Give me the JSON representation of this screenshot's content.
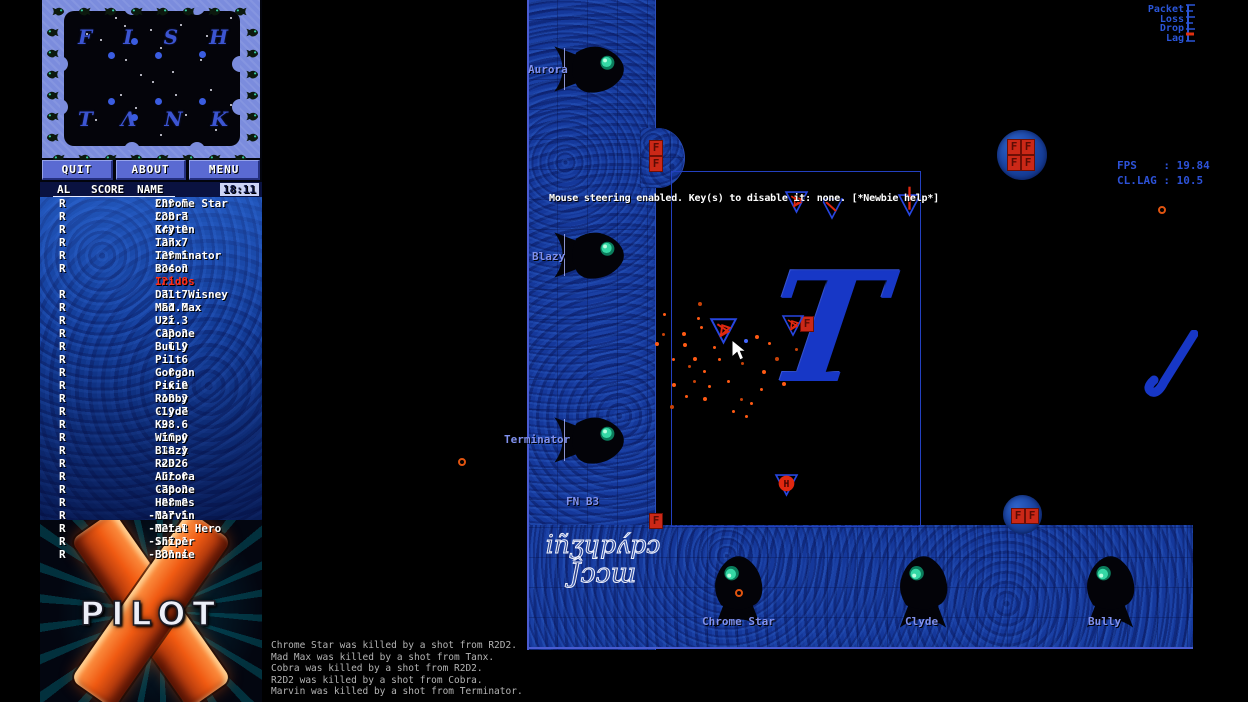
{
  "window": {
    "width": 1248,
    "height": 702,
    "app": "XPilot"
  },
  "colors": {
    "hud_blue": "#2d52d8",
    "label_blue": "#8091ee",
    "wall_blue": "#15389a",
    "self_red": "#ff2e18",
    "fuel_red": "#cb2817",
    "orange_debris": "#ff5a14",
    "ship_blue": "#2746e0",
    "frame_periwinkle": "#7b8cdd"
  },
  "radar": {
    "map_title_top": [
      "F",
      "I",
      "S",
      "H"
    ],
    "map_title_bottom": [
      "T",
      "Λ",
      "N",
      "K"
    ],
    "stars": [
      [
        51,
        6
      ],
      [
        86,
        18
      ],
      [
        116,
        13
      ],
      [
        166,
        6
      ],
      [
        36,
        28
      ],
      [
        61,
        48
      ],
      [
        96,
        36
      ],
      [
        136,
        48
      ],
      [
        76,
        63
      ],
      [
        88,
        70
      ],
      [
        56,
        83
      ],
      [
        111,
        83
      ],
      [
        146,
        78
      ],
      [
        166,
        93
      ],
      [
        31,
        108
      ],
      [
        71,
        96
      ],
      [
        121,
        103
      ],
      [
        151,
        118
      ],
      [
        96,
        123
      ],
      [
        174,
        46
      ],
      [
        22,
        22
      ],
      [
        142,
        24
      ],
      [
        60,
        14
      ],
      [
        108,
        60
      ]
    ],
    "planets": [
      [
        47,
        44
      ],
      [
        94,
        44
      ],
      [
        138,
        43
      ],
      [
        47,
        90
      ],
      [
        94,
        90
      ],
      [
        138,
        90
      ],
      [
        70,
        30
      ],
      [
        70,
        106
      ]
    ]
  },
  "menu_buttons": [
    {
      "label": "QUIT"
    },
    {
      "label": "ABOUT"
    },
    {
      "label": "MENU"
    }
  ],
  "score_table": {
    "col_al": "AL",
    "col_score": "SCORE",
    "col_name": "NAME",
    "clock": "18:11",
    "rows": [
      {
        "flag": "R",
        "score": "229.5",
        "name": "Chrome Star",
        "self": false
      },
      {
        "flag": "R",
        "score": "223.7",
        "name": "Cobra",
        "self": false
      },
      {
        "flag": "R",
        "score": "143.9",
        "name": "Kryten",
        "self": false
      },
      {
        "flag": "R",
        "score": "137.7",
        "name": "Tanx",
        "self": false
      },
      {
        "flag": "R",
        "score": "129.5",
        "name": "Terminator",
        "self": false
      },
      {
        "flag": "R",
        "score": "124.3",
        "name": "Boson",
        "self": false
      },
      {
        "flag": "",
        "score": "121.8",
        "name": "Iridos",
        "self": true
      },
      {
        "flag": "R",
        "score": "71.7",
        "name": "Dalt Wisney",
        "self": false
      },
      {
        "flag": "R",
        "score": "51.9",
        "name": "Mad Max",
        "self": false
      },
      {
        "flag": "R",
        "score": "32.3",
        "name": "Uzi",
        "self": false
      },
      {
        "flag": "R",
        "score": "32.2",
        "name": "Capone",
        "self": false
      },
      {
        "flag": "R",
        "score": "6.9",
        "name": "Bully",
        "self": false
      },
      {
        "flag": "R",
        "score": "1.6",
        "name": "Pilt",
        "self": false
      },
      {
        "flag": "R",
        "score": "0.3",
        "name": "Gorgon",
        "self": false
      },
      {
        "flag": "R",
        "score": "-6.9",
        "name": "Pixie",
        "self": false
      },
      {
        "flag": "R",
        "score": "-18.3",
        "name": "Robby",
        "self": false
      },
      {
        "flag": "R",
        "score": "-19.7",
        "name": "Clyde",
        "self": false
      },
      {
        "flag": "R",
        "score": "-28.6",
        "name": "K9",
        "self": false
      },
      {
        "flag": "R",
        "score": "-36.0",
        "name": "Wimpy",
        "self": false
      },
      {
        "flag": "R",
        "score": "-38.1",
        "name": "Blazy",
        "self": false
      },
      {
        "flag": "R",
        "score": "-45.6",
        "name": "R2D2",
        "self": false
      },
      {
        "flag": "R",
        "score": "-51.0",
        "name": "Aurora",
        "self": false
      },
      {
        "flag": "R",
        "score": "-78.2",
        "name": "Capone",
        "self": false
      },
      {
        "flag": "R",
        "score": "-88.8",
        "name": "Hermes",
        "self": false
      },
      {
        "flag": "R",
        "score": "-117.5",
        "name": "Marvin",
        "self": false
      },
      {
        "flag": "R",
        "score": "-121.8",
        "name": "Metal Hero",
        "self": false
      },
      {
        "flag": "R",
        "score": "-157.1",
        "name": "Sniper",
        "self": false
      },
      {
        "flag": "R",
        "score": "-231.4",
        "name": "Bonnie",
        "self": false
      }
    ]
  },
  "logo": {
    "text": "PILOT"
  },
  "kill_feed": [
    "Chrome Star was killed by a shot from R2D2.",
    "Mad Max was killed by a shot from Tanx.",
    "Cobra was killed by a shot from R2D2.",
    "R2D2 was killed by a shot from Cobra.",
    "Marvin was killed by a shot from Terminator."
  ],
  "hud": {
    "message": "Mouse steering enabled. Key(s) to disable it: none. [*Newbie help*]",
    "fps": "FPS    : 19.84",
    "cl_lag": "CL.LAG : 10.5",
    "net_meter_labels": [
      "Packet",
      "Loss",
      "Drop",
      "Lag"
    ]
  },
  "game": {
    "player_labels": [
      {
        "text": "Aurora",
        "x": 528,
        "y": 63
      },
      {
        "text": "Blazy",
        "x": 532,
        "y": 250
      },
      {
        "text": "Terminator",
        "x": 504,
        "y": 433
      },
      {
        "text": "Chrome Star",
        "x": 702,
        "y": 615
      },
      {
        "text": "Clyde",
        "x": 905,
        "y": 615
      },
      {
        "text": "Bully",
        "x": 1088,
        "y": 615
      }
    ],
    "base_label": {
      "text": "FN B3",
      "x": 566,
      "y": 495
    },
    "decoration_letters": {
      "big_t": "T",
      "script_line1": "iñʒɥpʌ́pɔ",
      "script_line2": "Ĵɔɔɯ"
    },
    "wall_fish": [
      {
        "x": 552,
        "y": 42,
        "w": 78,
        "h": 54,
        "dir": "right"
      },
      {
        "x": 552,
        "y": 228,
        "w": 78,
        "h": 54,
        "dir": "right"
      },
      {
        "x": 552,
        "y": 413,
        "w": 78,
        "h": 54,
        "dir": "right"
      },
      {
        "x": 710,
        "y": 550,
        "w": 56,
        "h": 80,
        "dir": "up"
      },
      {
        "x": 895,
        "y": 550,
        "w": 56,
        "h": 80,
        "dir": "up"
      },
      {
        "x": 1082,
        "y": 550,
        "w": 56,
        "h": 80,
        "dir": "up"
      }
    ],
    "fuel": {
      "letter": "F",
      "cells": [
        [
          649,
          140
        ],
        [
          649,
          156
        ],
        [
          1007,
          139
        ],
        [
          1021,
          139
        ],
        [
          1007,
          155
        ],
        [
          1021,
          155
        ],
        [
          649,
          513
        ],
        [
          1011,
          508
        ],
        [
          1025,
          508
        ],
        [
          800,
          316
        ]
      ]
    },
    "islands": [
      {
        "x": 997,
        "y": 130,
        "d": 50
      },
      {
        "x": 1003,
        "y": 495,
        "d": 39
      }
    ],
    "ships": [
      {
        "x": 710,
        "y": 316,
        "size": 27,
        "variant": "debris"
      },
      {
        "x": 782,
        "y": 313,
        "size": 22,
        "variant": "debris"
      },
      {
        "x": 785,
        "y": 189,
        "size": 23,
        "variant": "debris"
      },
      {
        "x": 821,
        "y": 196,
        "size": 22,
        "variant": "line"
      },
      {
        "x": 898,
        "y": 192,
        "size": 23,
        "variant": "antenna"
      },
      {
        "x": 775,
        "y": 472,
        "size": 23,
        "variant": "ball",
        "letter": "H"
      }
    ],
    "particles": [
      [
        698,
        302
      ],
      [
        663,
        313
      ],
      [
        697,
        317
      ],
      [
        682,
        332
      ],
      [
        662,
        333
      ],
      [
        720,
        333
      ],
      [
        683,
        343
      ],
      [
        768,
        342
      ],
      [
        795,
        348
      ],
      [
        693,
        357
      ],
      [
        672,
        358
      ],
      [
        718,
        358
      ],
      [
        775,
        357
      ],
      [
        703,
        370
      ],
      [
        727,
        380
      ],
      [
        672,
        383
      ],
      [
        693,
        380
      ],
      [
        708,
        385
      ],
      [
        782,
        382
      ],
      [
        760,
        388
      ],
      [
        740,
        398
      ],
      [
        703,
        397
      ],
      [
        750,
        402
      ],
      [
        732,
        410
      ],
      [
        670,
        405
      ],
      [
        685,
        395
      ],
      [
        745,
        415
      ],
      [
        762,
        370
      ],
      [
        688,
        365
      ],
      [
        713,
        346
      ],
      [
        655,
        342
      ],
      [
        700,
        326
      ],
      [
        741,
        362
      ],
      [
        755,
        335
      ]
    ],
    "blue_spark": {
      "x": 744,
      "y": 339
    },
    "rings": [
      {
        "x": 458,
        "y": 458
      },
      {
        "x": 1158,
        "y": 206
      },
      {
        "x": 735,
        "y": 589
      }
    ],
    "cursor": {
      "x": 731,
      "y": 339
    }
  }
}
